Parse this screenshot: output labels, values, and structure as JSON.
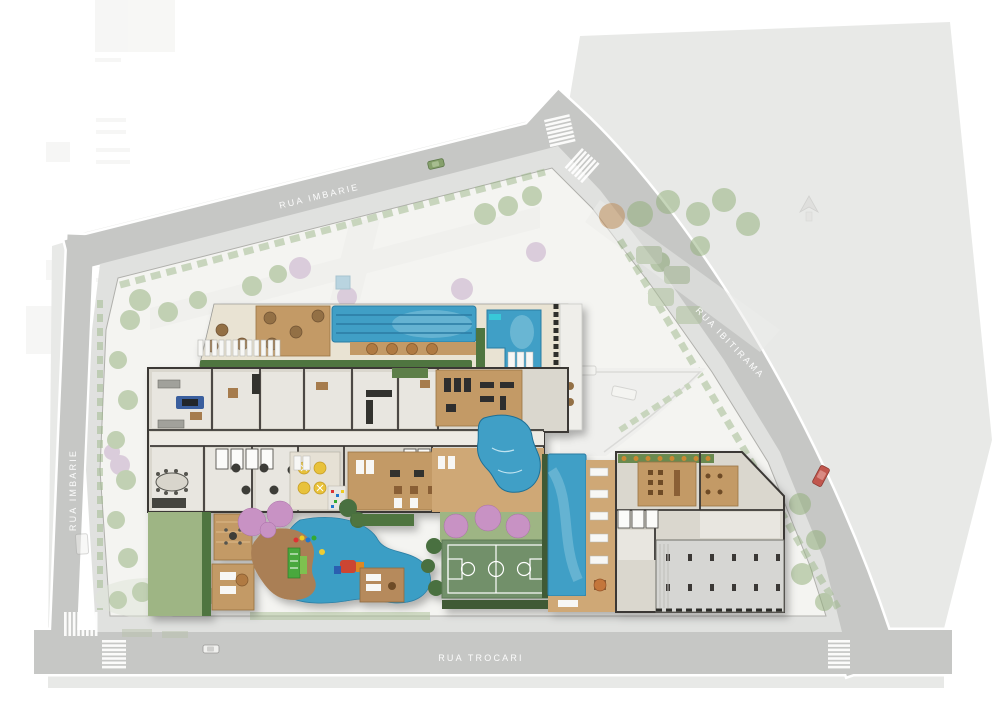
{
  "streets": {
    "top": {
      "label": "RUA IMBARIE"
    },
    "left": {
      "label": "RUA IMBARIE"
    },
    "right": {
      "label": "RUA IBITIRAMA"
    },
    "bottom": {
      "label": "RUA TROCARI"
    }
  },
  "colors": {
    "road": "#c6c7c5",
    "road_outer": "#e8e9e7",
    "sidewalk": "#e0e1df",
    "site": "#f4f4f1",
    "label_text": "#ffffff",
    "pool_water": "#3f9fc6",
    "pool_water_light": "#8cc8de",
    "pool_lane": "#2a7ba3",
    "deck_floor": "#e9e3d3",
    "wood": "#c39a66",
    "wood_light": "#cfa876",
    "floor": "#dad7ce",
    "wall": "#3a3936",
    "hedge": "#4f7440",
    "grass": "#9eb584",
    "court": "#72906a",
    "court_line": "#ffffff",
    "playground_surface": "#3b9ec5",
    "playground_path": "#aa7f55",
    "pink_tree": "#c892c4",
    "garage": "#d6d6d3",
    "crosswalk": "#ffffff",
    "car_red": "#c1574e",
    "car_green": "#86a06c",
    "car_white": "#f0f0ee"
  }
}
